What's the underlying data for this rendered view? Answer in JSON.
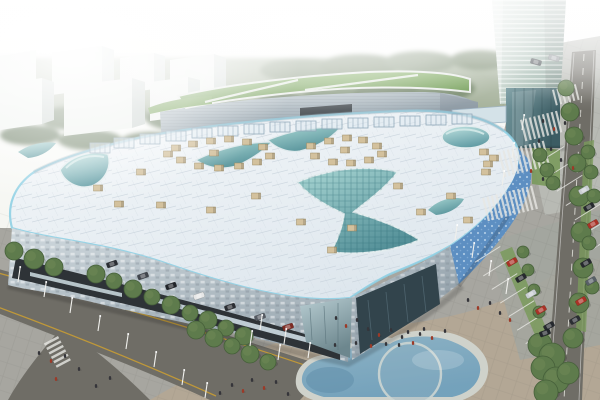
{
  "meta": {
    "type": "architectural-rendering",
    "subject": "Aerial daytime rendering of a large modern shopping mall with a free-form white roof, curved teal glass skylights, a glass office tower, rear annex with lawn roof, pedestrian plaza, kidney-shaped pond, tree-lined roads and a car park",
    "width": 600,
    "height": 400
  },
  "palette": {
    "sky_haze": "#f7f8f4",
    "tree_band": "#8a9b7a",
    "white_building_face": "#ecf0ec",
    "white_building_side": "#c9d2ce",
    "tower_glass": "#9eb4a9",
    "lawn_green": "#6f9c4e",
    "roof_white": "#eaeff3",
    "roof_trim": "#8fd0e4",
    "skylight_teal": "#7fb9ba",
    "facade_metal": "#b9c6cf",
    "facade_dark": "#2e3337",
    "facade_blue": "#5d8fc2",
    "plaza_gray": "#a7a6a0",
    "plaza_tan": "#b3a795",
    "plaza_light": "#b8bab4",
    "road_dark": "#6f6d66",
    "road_line_yellow": "#c89c34",
    "pond_water": "#7ba9c2",
    "pond_rim": "#cfd2cb",
    "hvac_tan": "#d3c19d"
  },
  "scene": {
    "background": {
      "sky": "hazy white sky",
      "trees": "green tree belt behind buildings"
    },
    "buildings": {
      "residential_blocks": 7,
      "tower": {
        "label": "glass office tower",
        "floors_visible": 22
      },
      "annex": {
        "label": "rear annex block with green lawn roof and white paths"
      },
      "mall": {
        "label": "main mall with curved white roof",
        "skylights": [
          "central bowtie skylight",
          "left eye dome",
          "right oval dome",
          "crescent skylight strips"
        ]
      }
    },
    "ground": {
      "pond": "kidney-shaped water feature with overlapping circle",
      "roads": [
        "diagonal avenue with yellow edge lines",
        "right boulevard with dashed lane lines and tree row"
      ],
      "parking": "car park with planted green strips",
      "plaza": "pedestrian plaza with striped crosswalk paving and scattered people"
    }
  },
  "scatter_styles": {
    "person_dark": "#35353a",
    "person_red": "#9c3a28",
    "tree_fill": "#5e7b4c",
    "tree_edge": "#46603a",
    "pole": "#f0f0ec",
    "hvac_fill": "#d3c19d",
    "hvac_edge": "#9c8a61",
    "truss_fill": "#dfe9f0",
    "truss_edge": "#92a9ba",
    "stripe_white": "#e8e8e4"
  },
  "scatter": {
    "people": [
      [
        336,
        318,
        "d"
      ],
      [
        346,
        326,
        "r"
      ],
      [
        357,
        320,
        "d"
      ],
      [
        368,
        329,
        "d"
      ],
      [
        379,
        335,
        "r"
      ],
      [
        391,
        330,
        "d"
      ],
      [
        402,
        337,
        "d"
      ],
      [
        413,
        343,
        "r"
      ],
      [
        399,
        345,
        "d"
      ],
      [
        386,
        344,
        "d"
      ],
      [
        371,
        346,
        "r"
      ],
      [
        356,
        343,
        "d"
      ],
      [
        420,
        334,
        "d"
      ],
      [
        432,
        338,
        "r"
      ],
      [
        445,
        331,
        "d"
      ],
      [
        408,
        332,
        "d"
      ],
      [
        424,
        329,
        "d"
      ],
      [
        252,
        380,
        "d"
      ],
      [
        264,
        388,
        "r"
      ],
      [
        276,
        382,
        "d"
      ],
      [
        288,
        394,
        "d"
      ],
      [
        243,
        391,
        "r"
      ],
      [
        232,
        385,
        "d"
      ],
      [
        220,
        393,
        "d"
      ],
      [
        468,
        300,
        "d"
      ],
      [
        478,
        308,
        "r"
      ],
      [
        490,
        303,
        "d"
      ],
      [
        500,
        313,
        "d"
      ],
      [
        510,
        320,
        "r"
      ],
      [
        543,
        121,
        "d"
      ],
      [
        554,
        129,
        "r"
      ],
      [
        565,
        123,
        "d"
      ],
      [
        539,
        141,
        "d"
      ],
      [
        551,
        149,
        "d"
      ],
      [
        531,
        171,
        "r"
      ],
      [
        543,
        179,
        "d"
      ],
      [
        561,
        160,
        "d"
      ],
      [
        573,
        168,
        "r"
      ],
      [
        39,
        353,
        "d"
      ],
      [
        51,
        361,
        "r"
      ],
      [
        65,
        356,
        "d"
      ],
      [
        79,
        369,
        "d"
      ],
      [
        56,
        379,
        "r"
      ],
      [
        96,
        386,
        "d"
      ],
      [
        110,
        378,
        "d"
      ],
      [
        335,
        345,
        "d"
      ]
    ],
    "cars": [
      [
        112,
        264,
        -19,
        "#2b2e33"
      ],
      [
        143,
        276,
        -19,
        "#41464d"
      ],
      [
        171,
        286,
        -19,
        "#22252a"
      ],
      [
        199,
        296,
        -19,
        "#e6e7e7"
      ],
      [
        230,
        307,
        -19,
        "#2b2e33"
      ],
      [
        260,
        317,
        -19,
        "#565b63"
      ],
      [
        288,
        327,
        -19,
        "#7e2c24"
      ],
      [
        512,
        262,
        -30,
        "#a93226"
      ],
      [
        521,
        278,
        -30,
        "#26292e"
      ],
      [
        531,
        294,
        -30,
        "#c9ced2"
      ],
      [
        541,
        310,
        -30,
        "#a93226"
      ],
      [
        549,
        326,
        -30,
        "#26292e"
      ],
      [
        545,
        333,
        -20,
        "#22262b"
      ],
      [
        584,
        190,
        -30,
        "#c9ced2"
      ],
      [
        589,
        207,
        -30,
        "#26292e"
      ],
      [
        593,
        224,
        -30,
        "#a93226"
      ],
      [
        586,
        263,
        -30,
        "#26292e"
      ],
      [
        591,
        281,
        -30,
        "#586067"
      ],
      [
        581,
        301,
        -30,
        "#a93226"
      ],
      [
        575,
        320,
        -30,
        "#2b2e33"
      ],
      [
        536,
        62,
        15,
        "#3a3f45"
      ],
      [
        554,
        58,
        15,
        "#888d92"
      ]
    ],
    "street_trees": [
      [
        14,
        251,
        9
      ],
      [
        34,
        259,
        10
      ],
      [
        54,
        267,
        9
      ],
      [
        96,
        274,
        9
      ],
      [
        114,
        281,
        8
      ],
      [
        133,
        289,
        9
      ],
      [
        152,
        297,
        8
      ],
      [
        171,
        305,
        9
      ],
      [
        190,
        313,
        8
      ],
      [
        208,
        320,
        9
      ],
      [
        226,
        328,
        8
      ],
      [
        244,
        336,
        9
      ],
      [
        196,
        330,
        9
      ],
      [
        214,
        338,
        9
      ],
      [
        232,
        346,
        8
      ],
      [
        250,
        354,
        9
      ],
      [
        268,
        362,
        8
      ],
      [
        540,
        345,
        12
      ],
      [
        552,
        356,
        13
      ],
      [
        543,
        368,
        12
      ],
      [
        556,
        380,
        13
      ],
      [
        546,
        392,
        12
      ],
      [
        566,
        88,
        8
      ],
      [
        570,
        112,
        9
      ],
      [
        574,
        136,
        9
      ],
      [
        577,
        163,
        9
      ],
      [
        579,
        196,
        10
      ],
      [
        581,
        232,
        10
      ],
      [
        583,
        268,
        10
      ],
      [
        579,
        303,
        10
      ],
      [
        573,
        338,
        10
      ],
      [
        568,
        373,
        11
      ],
      [
        523,
        252,
        6
      ],
      [
        528,
        270,
        6
      ],
      [
        534,
        290,
        6
      ],
      [
        539,
        312,
        6
      ],
      [
        588,
        152,
        7
      ],
      [
        591,
        172,
        7
      ],
      [
        594,
        196,
        7
      ],
      [
        589,
        243,
        7
      ],
      [
        592,
        287,
        7
      ],
      [
        540,
        155,
        7
      ],
      [
        547,
        170,
        7
      ],
      [
        553,
        183,
        7
      ]
    ],
    "light_poles": [
      [
        18,
        282
      ],
      [
        44,
        297
      ],
      [
        70,
        313
      ],
      [
        98,
        331
      ],
      [
        126,
        349
      ],
      [
        154,
        367
      ],
      [
        182,
        385
      ],
      [
        205,
        398
      ],
      [
        260,
        330
      ],
      [
        284,
        344
      ],
      [
        308,
        358
      ],
      [
        250,
        346
      ],
      [
        278,
        360
      ],
      [
        455,
        240
      ],
      [
        472,
        258
      ],
      [
        489,
        276
      ],
      [
        506,
        294
      ],
      [
        522,
        130
      ],
      [
        512,
        158
      ],
      [
        502,
        186
      ]
    ],
    "hvac_units": [
      [
        176,
        148
      ],
      [
        193,
        144
      ],
      [
        211,
        141
      ],
      [
        229,
        139
      ],
      [
        247,
        142
      ],
      [
        263,
        147
      ],
      [
        270,
        156
      ],
      [
        257,
        162
      ],
      [
        239,
        166
      ],
      [
        219,
        168
      ],
      [
        199,
        166
      ],
      [
        181,
        160
      ],
      [
        168,
        154
      ],
      [
        214,
        153
      ],
      [
        311,
        146
      ],
      [
        329,
        141
      ],
      [
        347,
        138
      ],
      [
        363,
        140
      ],
      [
        377,
        146
      ],
      [
        382,
        154
      ],
      [
        369,
        160
      ],
      [
        351,
        163
      ],
      [
        333,
        162
      ],
      [
        315,
        156
      ],
      [
        345,
        150
      ],
      [
        98,
        188
      ],
      [
        141,
        172
      ],
      [
        161,
        205
      ],
      [
        211,
        210
      ],
      [
        256,
        196
      ],
      [
        301,
        222
      ],
      [
        352,
        228
      ],
      [
        398,
        186
      ],
      [
        421,
        212
      ],
      [
        451,
        196
      ],
      [
        468,
        220
      ],
      [
        486,
        172
      ],
      [
        119,
        204
      ],
      [
        332,
        250
      ],
      [
        484,
        152
      ],
      [
        494,
        158
      ],
      [
        488,
        164
      ]
    ],
    "roof_trusses": [
      [
        100,
        148
      ],
      [
        124,
        143
      ],
      [
        150,
        139
      ],
      [
        176,
        136
      ],
      [
        202,
        133
      ],
      [
        228,
        131
      ],
      [
        254,
        129
      ],
      [
        280,
        127
      ],
      [
        306,
        126
      ],
      [
        332,
        124
      ],
      [
        358,
        123
      ],
      [
        384,
        122
      ],
      [
        410,
        121
      ],
      [
        436,
        120
      ],
      [
        462,
        119
      ]
    ],
    "pavement_stripes": [
      [
        520,
        120,
        -14,
        9,
        22,
        2.2,
        4.5
      ],
      [
        498,
        152,
        -14,
        11,
        26,
        2.2,
        4.5
      ],
      [
        482,
        198,
        -14,
        12,
        24,
        2.2,
        4.5
      ],
      [
        58,
        336,
        62,
        6,
        16,
        2.5,
        5
      ],
      [
        552,
        90,
        -14,
        6,
        16,
        2,
        4.5
      ],
      [
        500,
        246,
        58,
        7,
        30,
        1,
        16
      ],
      [
        564,
        146,
        58,
        10,
        30,
        1,
        17
      ]
    ]
  }
}
